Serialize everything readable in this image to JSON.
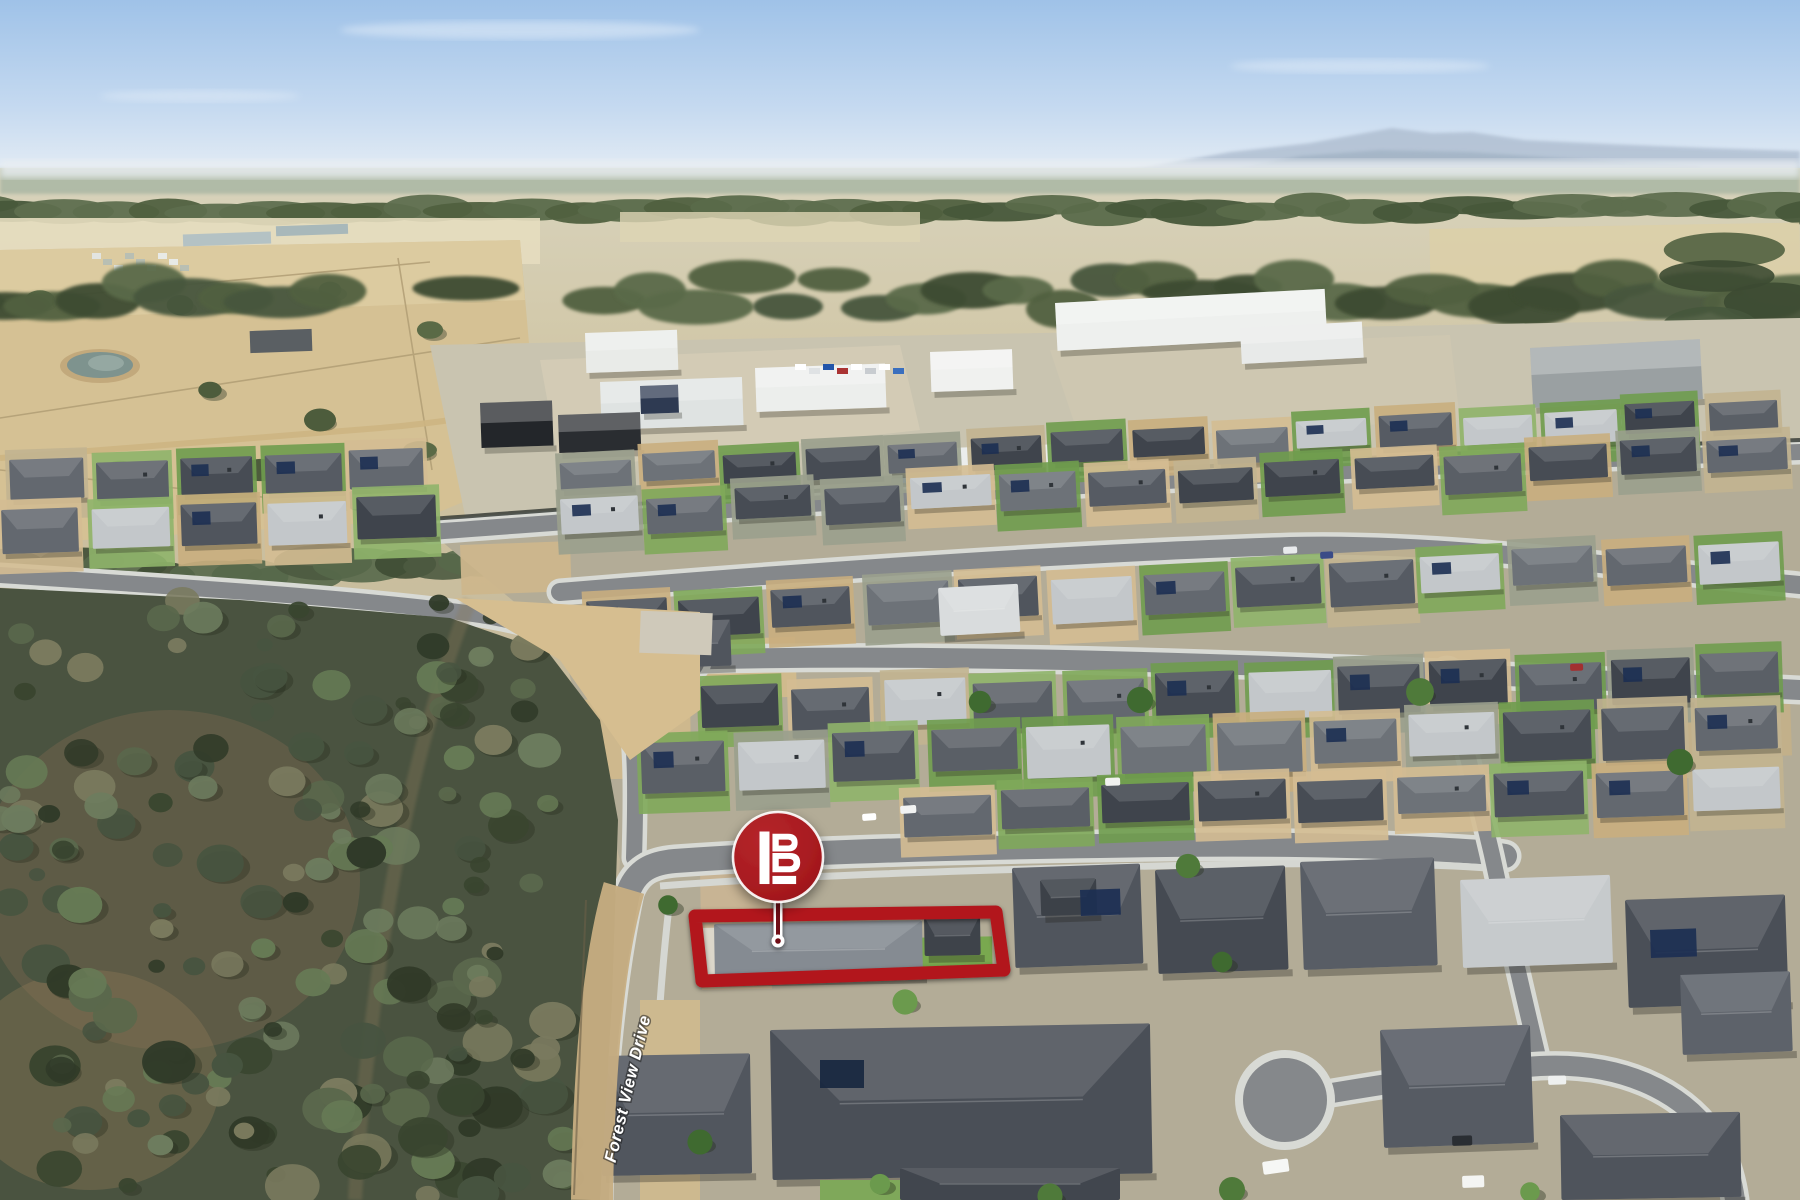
{
  "overlay": {
    "street_label": "Forest View Drive",
    "logo_letter": "B"
  },
  "colors": {
    "brand_red": "#A6191E",
    "brand_red_light": "#B5262B",
    "boundary_red": "#B2191E",
    "pointer_dark_red": "#701114",
    "label_white": "#FFFFFF",
    "sky_top": "#9FC2E8",
    "sky_horizon": "#EEF2F6",
    "roof_charcoal": "#51565E",
    "lawn_green": "#7FA85A",
    "bush_green": "#4A5340",
    "paddock_tan": "#D5C194",
    "road_grey": "#85888B"
  }
}
